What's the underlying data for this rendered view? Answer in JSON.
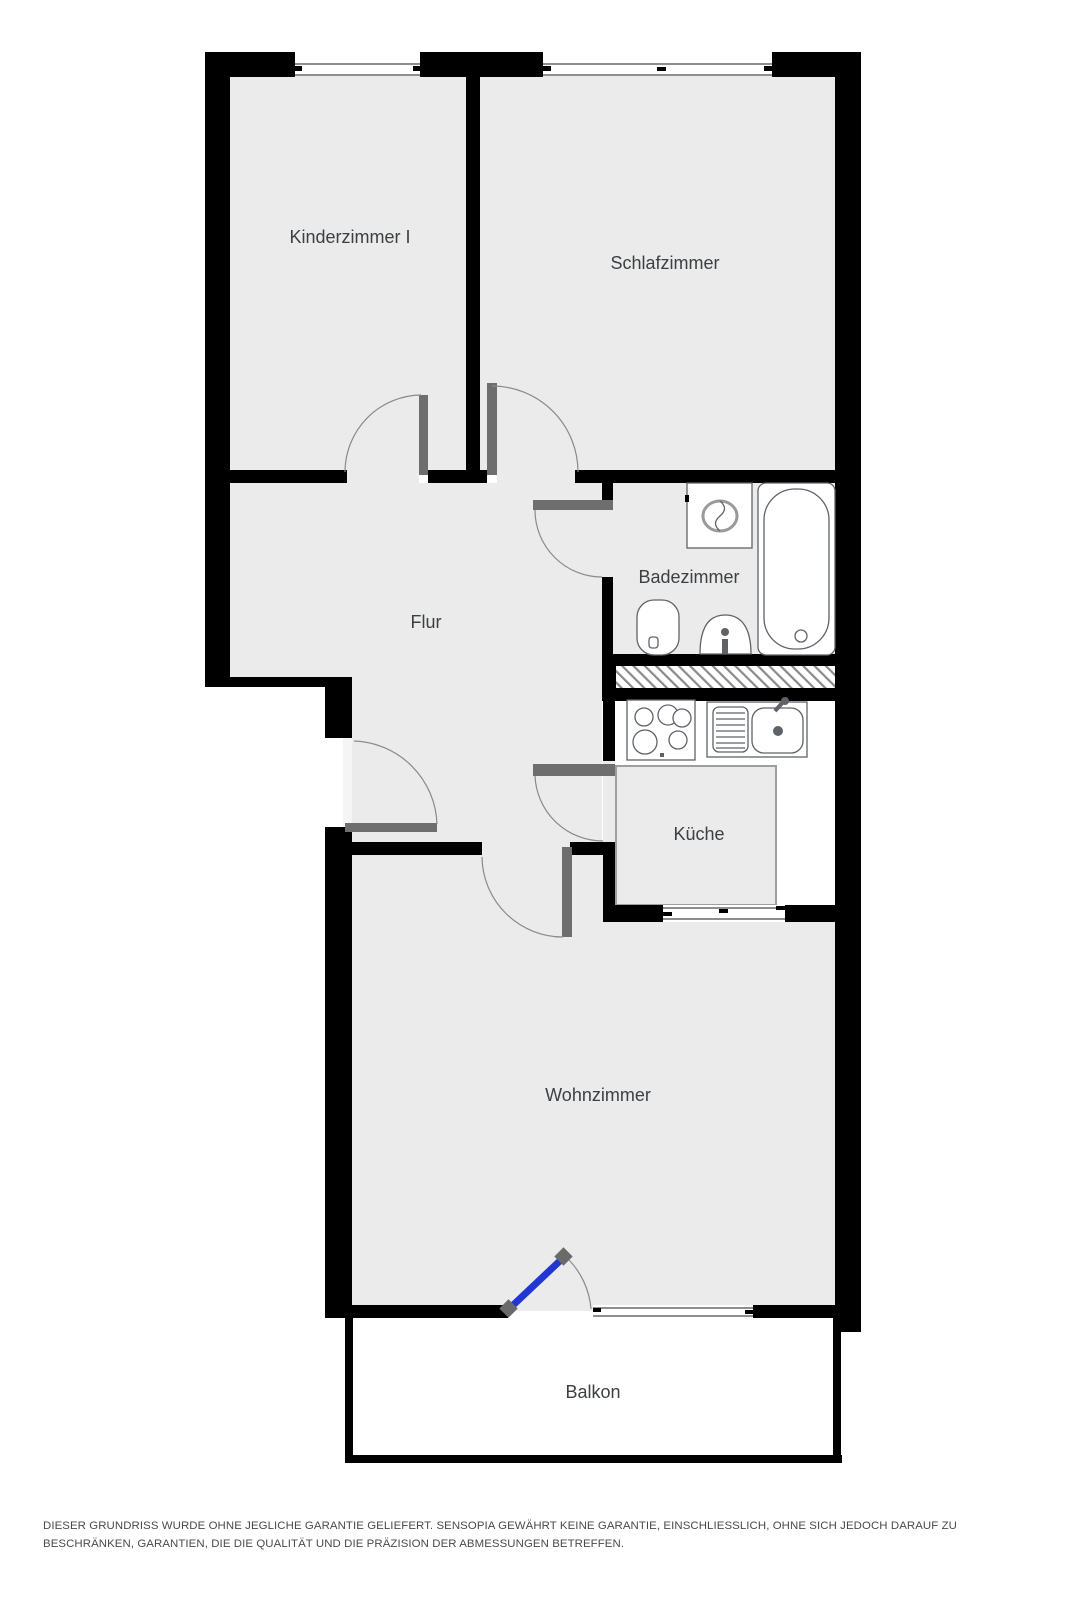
{
  "plan_type": "floor-plan",
  "rooms": {
    "kinderzimmer": {
      "label": "Kinderzimmer I"
    },
    "schlafzimmer": {
      "label": "Schlafzimmer"
    },
    "badezimmer": {
      "label": "Badezimmer"
    },
    "flur": {
      "label": "Flur"
    },
    "kueche": {
      "label": "Küche"
    },
    "wohnzimmer": {
      "label": "Wohnzimmer"
    },
    "balkon": {
      "label": "Balkon"
    }
  },
  "fixtures": [
    "washing-machine",
    "bathtub",
    "toilet",
    "sink",
    "stove",
    "kitchen-sink"
  ],
  "colors": {
    "wall": "#000000",
    "floor": "#ebebeb",
    "floor_outline": "#9e9e9e",
    "door": "#6e6e6e",
    "arc": "#8a8a8a",
    "balcony_door": "#2236d4",
    "hinge": "#6a6a6a",
    "fixture": "#5f6368",
    "fixture_soft": "#9a9a9a",
    "window_line": "#4a4a4a",
    "tick": "#000000",
    "entry_strip": "#f5f5f5",
    "hatch_line": "#8a8a8a",
    "label": "#3c4043",
    "disclaimer_text": "#4a4a4a"
  },
  "disclaimer": "DIESER GRUNDRISS WURDE OHNE JEGLICHE GARANTIE GELIEFERT. SENSOPIA GEWÄHRT KEINE GARANTIE, EINSCHLIESSLICH, OHNE SICH JEDOCH DARAUF ZU BESCHRÄNKEN, GARANTIEN, DIE DIE QUALITÄT UND DIE PRÄZISION DER ABMESSUNGEN BETREFFEN."
}
